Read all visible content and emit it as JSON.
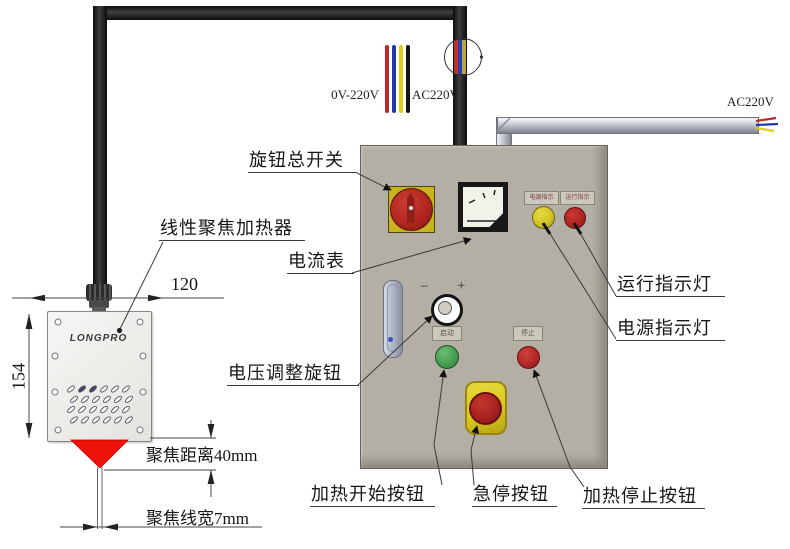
{
  "callouts": {
    "knob_switch": "旋钮总开关",
    "heater": "线性聚焦加热器",
    "ammeter": "电流表",
    "voltage_knob": "电压调整旋钮",
    "heat_start": "加热开始按钮",
    "estop": "急停按钮",
    "heat_stop": "加热停止按钮",
    "run_indicator": "运行指示灯",
    "power_indicator": "电源指示灯"
  },
  "wiring": {
    "adjustable_range": "0V-220V",
    "ac_left": "AC220V",
    "ac_right": "AC220V"
  },
  "dimensions": {
    "width": "120",
    "height": "154",
    "focus_distance": "聚焦距离40mm",
    "focus_line_width": "聚焦线宽7mm"
  },
  "panel": {
    "power_plate": "电源指示",
    "run_plate": "运行指示",
    "start_plate": "启动",
    "stop_plate": "停止",
    "minus": "−",
    "plus": "+"
  },
  "heater": {
    "logo": "LONGPRO"
  },
  "colors": {
    "panel_face": "#b3afa4",
    "switch_plate_yellow": "#c9b41e",
    "switch_red": "#b22620",
    "lamp_yellow": "#d2c422",
    "lamp_red": "#b02424",
    "button_green": "#46a050",
    "button_red": "#b42828",
    "estop_yellow": "#d9c820",
    "cone_red": "#ee1308",
    "wire_red": "#c02828",
    "wire_blue": "#2238a8",
    "wire_yellow": "#e0cc20",
    "wire_black": "#141414"
  }
}
